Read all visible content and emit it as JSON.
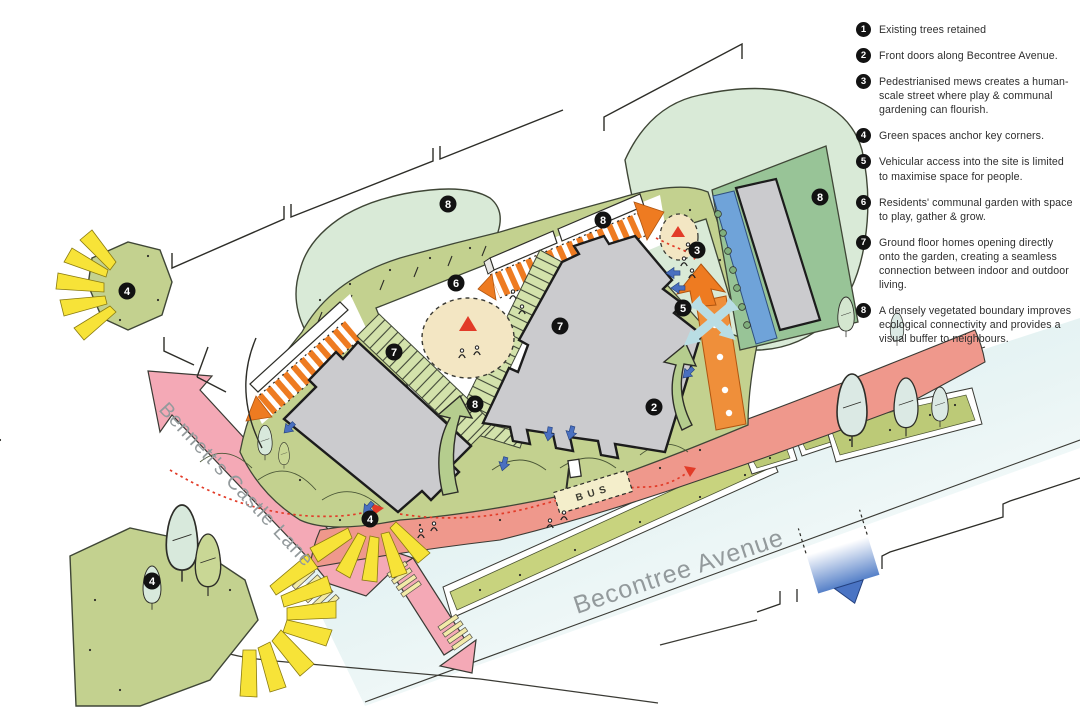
{
  "plan": {
    "street_labels": {
      "bennetts_castle_lane": "Bennett's Castle Lane",
      "becontree_avenue": "Becontree Avenue"
    },
    "bus_stop_label": "BUS",
    "badges": [
      "4",
      "8",
      "8",
      "3",
      "8",
      "6",
      "7",
      "7",
      "5",
      "8",
      "2",
      "4",
      "4"
    ]
  },
  "legend": {
    "items": [
      {
        "num": "1",
        "text": "Existing trees retained"
      },
      {
        "num": "2",
        "text": "Front doors along Becontree Avenue."
      },
      {
        "num": "3",
        "text": "Pedestrianised mews creates a human-scale street where play & communal gardening can flourish."
      },
      {
        "num": "4",
        "text": "Green spaces anchor key corners."
      },
      {
        "num": "5",
        "text": "Vehicular access into the site is limited to maximise space for people."
      },
      {
        "num": "6",
        "text": "Residents' communal garden with space to play, gather & grow."
      },
      {
        "num": "7",
        "text": "Ground floor homes opening directly onto the garden, creating a seamless connection between indoor and outdoor living."
      },
      {
        "num": "8",
        "text": "A densely vegetated boundary improves ecological connectivity and provides a visual buffer to neighbours."
      }
    ]
  },
  "palette": {
    "road_pink": "#f4a9b6",
    "frontage_salmon": "#ef988c",
    "avenue_blue": "#d9edef",
    "garden_olive": "#c3d18f",
    "veg_pale_green": "#d9ead7",
    "building_gray": "#cbcbce",
    "mews_orange": "#ee7b21",
    "corner_yellow": "#f7e338",
    "swale_blue": "#6fa3d9",
    "entry_blue": "#4a70c0",
    "path_red": "#e23b28",
    "play_beige": "#f3e6c3",
    "badge_black": "#121212"
  }
}
